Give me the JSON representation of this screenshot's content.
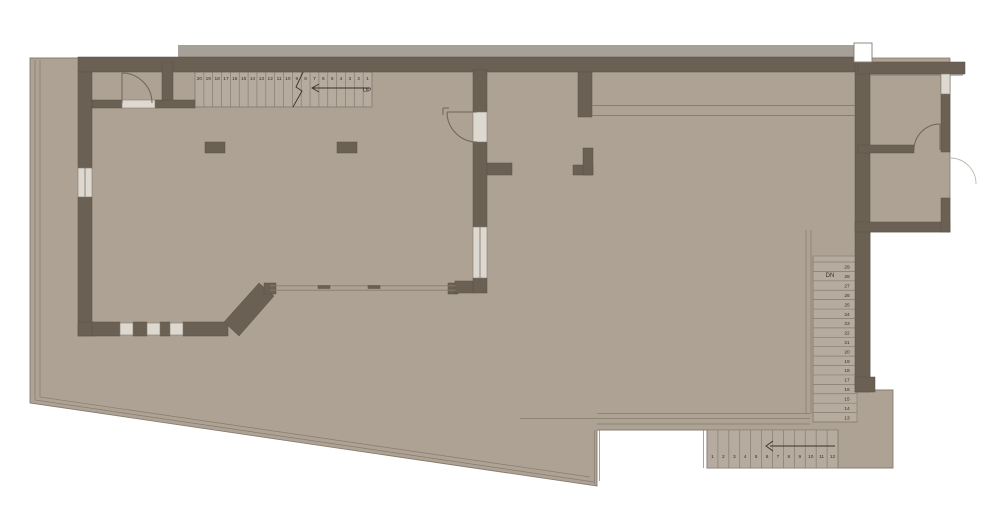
{
  "drawing": {
    "kind_label": "floor-plan",
    "stairs": {
      "top": {
        "direction_label": "UP",
        "steps": [
          "20",
          "19",
          "18",
          "17",
          "16",
          "15",
          "14",
          "13",
          "12",
          "11",
          "10",
          "9",
          "8",
          "7",
          "6",
          "5",
          "4",
          "3",
          "2",
          "1"
        ]
      },
      "right": {
        "direction_label": "DN",
        "steps": [
          "29",
          "28",
          "27",
          "26",
          "25",
          "24",
          "23",
          "22",
          "21",
          "20",
          "19",
          "18",
          "17",
          "16",
          "15",
          "14",
          "13"
        ]
      },
      "bottom": {
        "steps": [
          "1",
          "2",
          "3",
          "4",
          "5",
          "6",
          "7",
          "8",
          "9",
          "10",
          "11",
          "12"
        ]
      }
    }
  },
  "colors": {
    "floor": "#ada294",
    "tread": "#b5ab9f",
    "wall": "#6b6054",
    "wall_edge": "#595045",
    "line": "#877c6f",
    "door": "#6f6458",
    "window": "#ddd8d0",
    "strip": "#a5a098",
    "faint": "#beb7ae",
    "text": "#3a322a",
    "background": "#ffffff"
  }
}
